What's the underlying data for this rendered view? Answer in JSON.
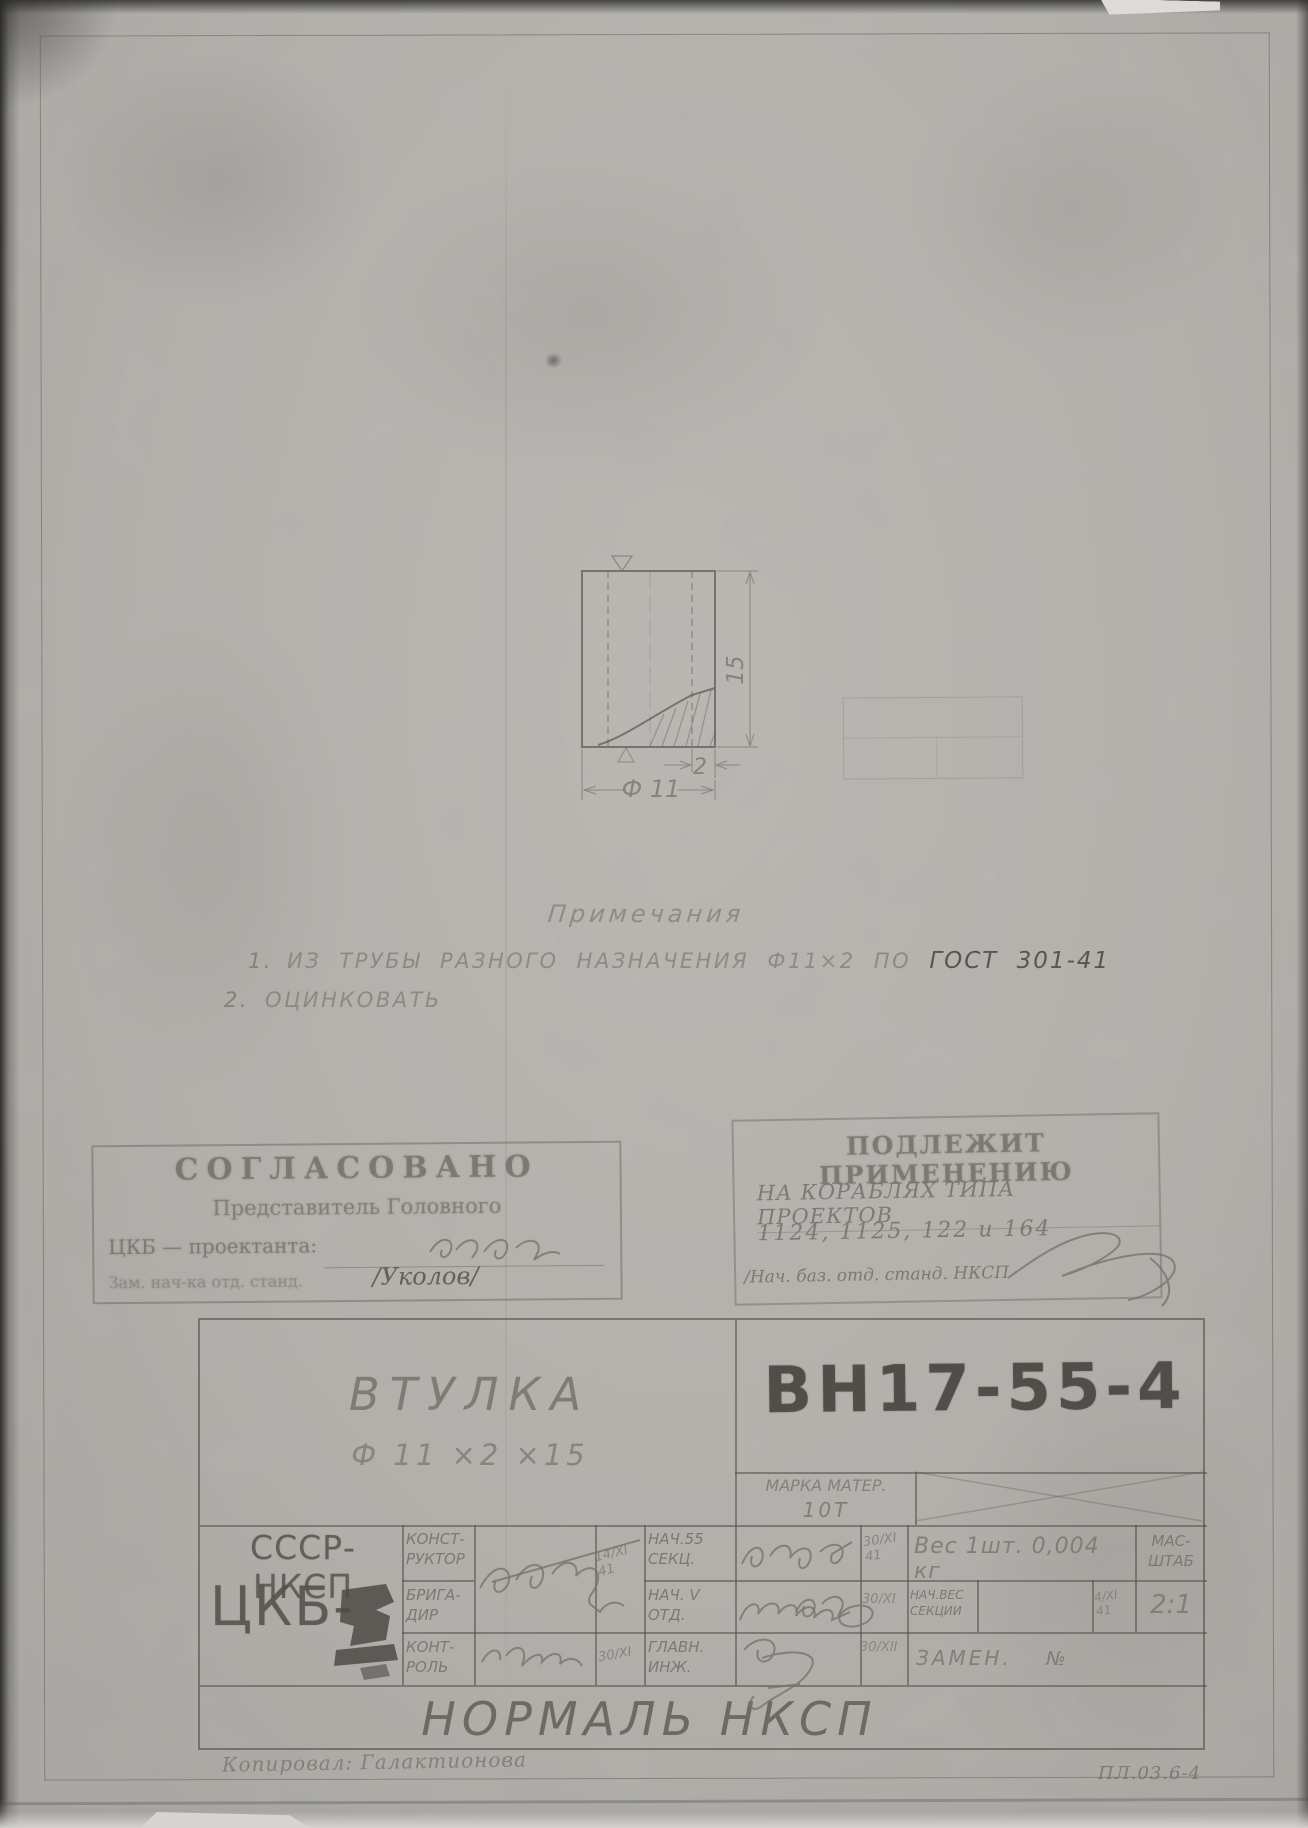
{
  "drawing": {
    "dim_height": "15",
    "dim_wall": "2",
    "dim_diameter": "Ф 11"
  },
  "notes": {
    "heading": "Примечания",
    "note1_num": "1.",
    "note1_text": "ИЗ  ТРУБЫ  РАЗНОГО  НАЗНАЧЕНИЯ  Ф11×2  ПО",
    "note1_gost": "ГОСТ 301-41",
    "note2_num": "2.",
    "note2_text": "ОЦИНКОВАТЬ"
  },
  "stamp_approved": {
    "title": "СОГЛАСОВАНО",
    "subtitle": "Представитель Головного",
    "org_label": "ЦКБ — проектанта:",
    "approver_label": "Зам. нач-ка отд. станд.",
    "approver": "/Уколов/"
  },
  "stamp_apply": {
    "title": "ПОДЛЕЖИТ ПРИМЕНЕНИЮ",
    "line1": "НА КОРАБЛЯХ ТИПА ПРОЕКТОВ",
    "line2": "1124, 1125, 122 и 164",
    "line3": "/Нач. баз. отд. станд. НКСП"
  },
  "title_block": {
    "part_name": "ВТУЛКА",
    "part_size": "Ф 11 ×2 ×15",
    "doc_number": "ВН17-55-4",
    "material_label": "МАРКА МАТЕР.",
    "material_value": "10Т",
    "org_country": "СССР-НКСП",
    "org_bureau": "ЦКБ-",
    "role_constructor": "КОНСТ-\nРУКТОР",
    "role_brigadier": "БРИГА-\nДИР",
    "role_control": "КОНТ-\nРОЛЬ",
    "date_1": "14/XI\n41",
    "date_control": "30/XI",
    "role_nach55": "НАЧ.55\nСЕКЦ.",
    "role_nachV": "НАЧ. V\nОТД.",
    "role_glavinzh": "ГЛАВН.\nИНЖ.",
    "date_2": "30/XI\n41",
    "date_3": "30/XI",
    "date_4": "30/XII",
    "weight": "Вес 1шт. 0,004 кг",
    "scale_label": "МАС-\nШТАБ",
    "scale_value": "2:1",
    "section_weight_label": "НАЧ.ВЕС\nСЕКЦИИ",
    "date_5": "4/XI\n41",
    "replace_label": "ЗАМЕН.",
    "replace_no": "№",
    "normal_title": "НОРМАЛЬ  НКСП"
  },
  "footer": {
    "copied_by": "Копировал: Галактионова",
    "doc_code": "ПЛ.03.6-4"
  }
}
